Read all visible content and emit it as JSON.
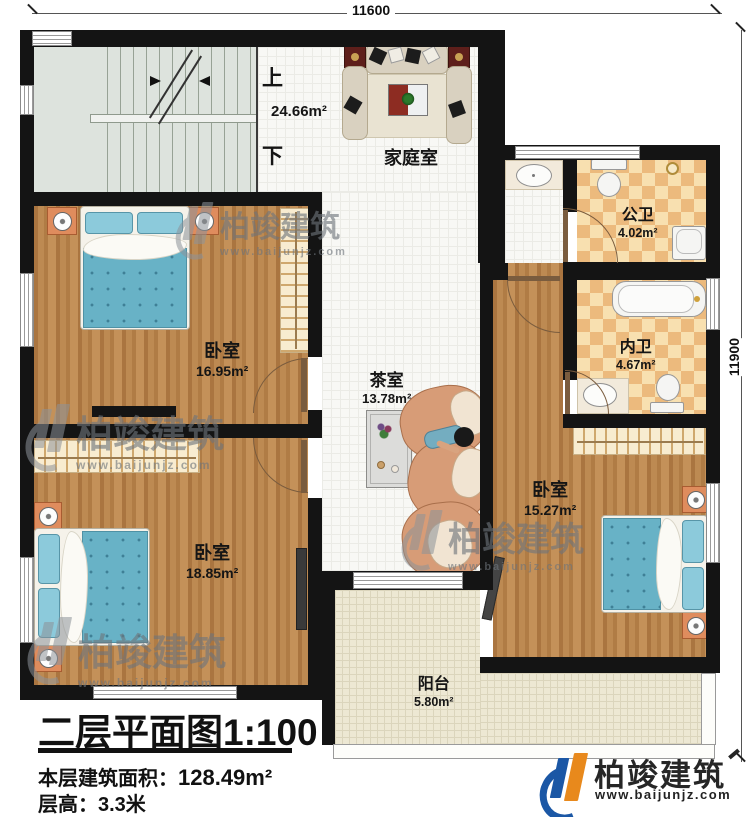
{
  "dims": {
    "top": "11600",
    "right": "11900"
  },
  "rooms": {
    "stairs": {
      "up": "上",
      "down": "下"
    },
    "family_room": {
      "name": "家庭室",
      "area": "24.66m²"
    },
    "public_bath": {
      "name": "公卫",
      "area": "4.02m²"
    },
    "private_bath": {
      "name": "内卫",
      "area": "4.67m²"
    },
    "bedroom_left_top": {
      "name": "卧室",
      "area": "16.95m²"
    },
    "bedroom_left_bottom": {
      "name": "卧室",
      "area": "18.85m²"
    },
    "bedroom_right": {
      "name": "卧室",
      "area": "15.27m²"
    },
    "tea_room": {
      "name": "茶室",
      "area": "13.78m²"
    },
    "balcony": {
      "name": "阳台",
      "area": "5.80m²"
    }
  },
  "title_block": {
    "plan_title": "二层平面图",
    "scale": "1:100",
    "area_label": "本层建筑面积：",
    "area_value": "128.49m²",
    "floor_height_label": "层高：",
    "floor_height_value": "3.3米"
  },
  "brand": {
    "name": "柏竣建筑",
    "url": "www.baijunjz.com"
  },
  "watermark": {
    "name": "柏竣建筑",
    "url": "www.baijunjz.com"
  },
  "colors": {
    "wall": "#141414",
    "wood": "#b5804a",
    "checker": "#ecba7d",
    "bedding": "#68b2c6",
    "brand_blue": "#1b57a5",
    "brand_orange": "#e8891c"
  }
}
